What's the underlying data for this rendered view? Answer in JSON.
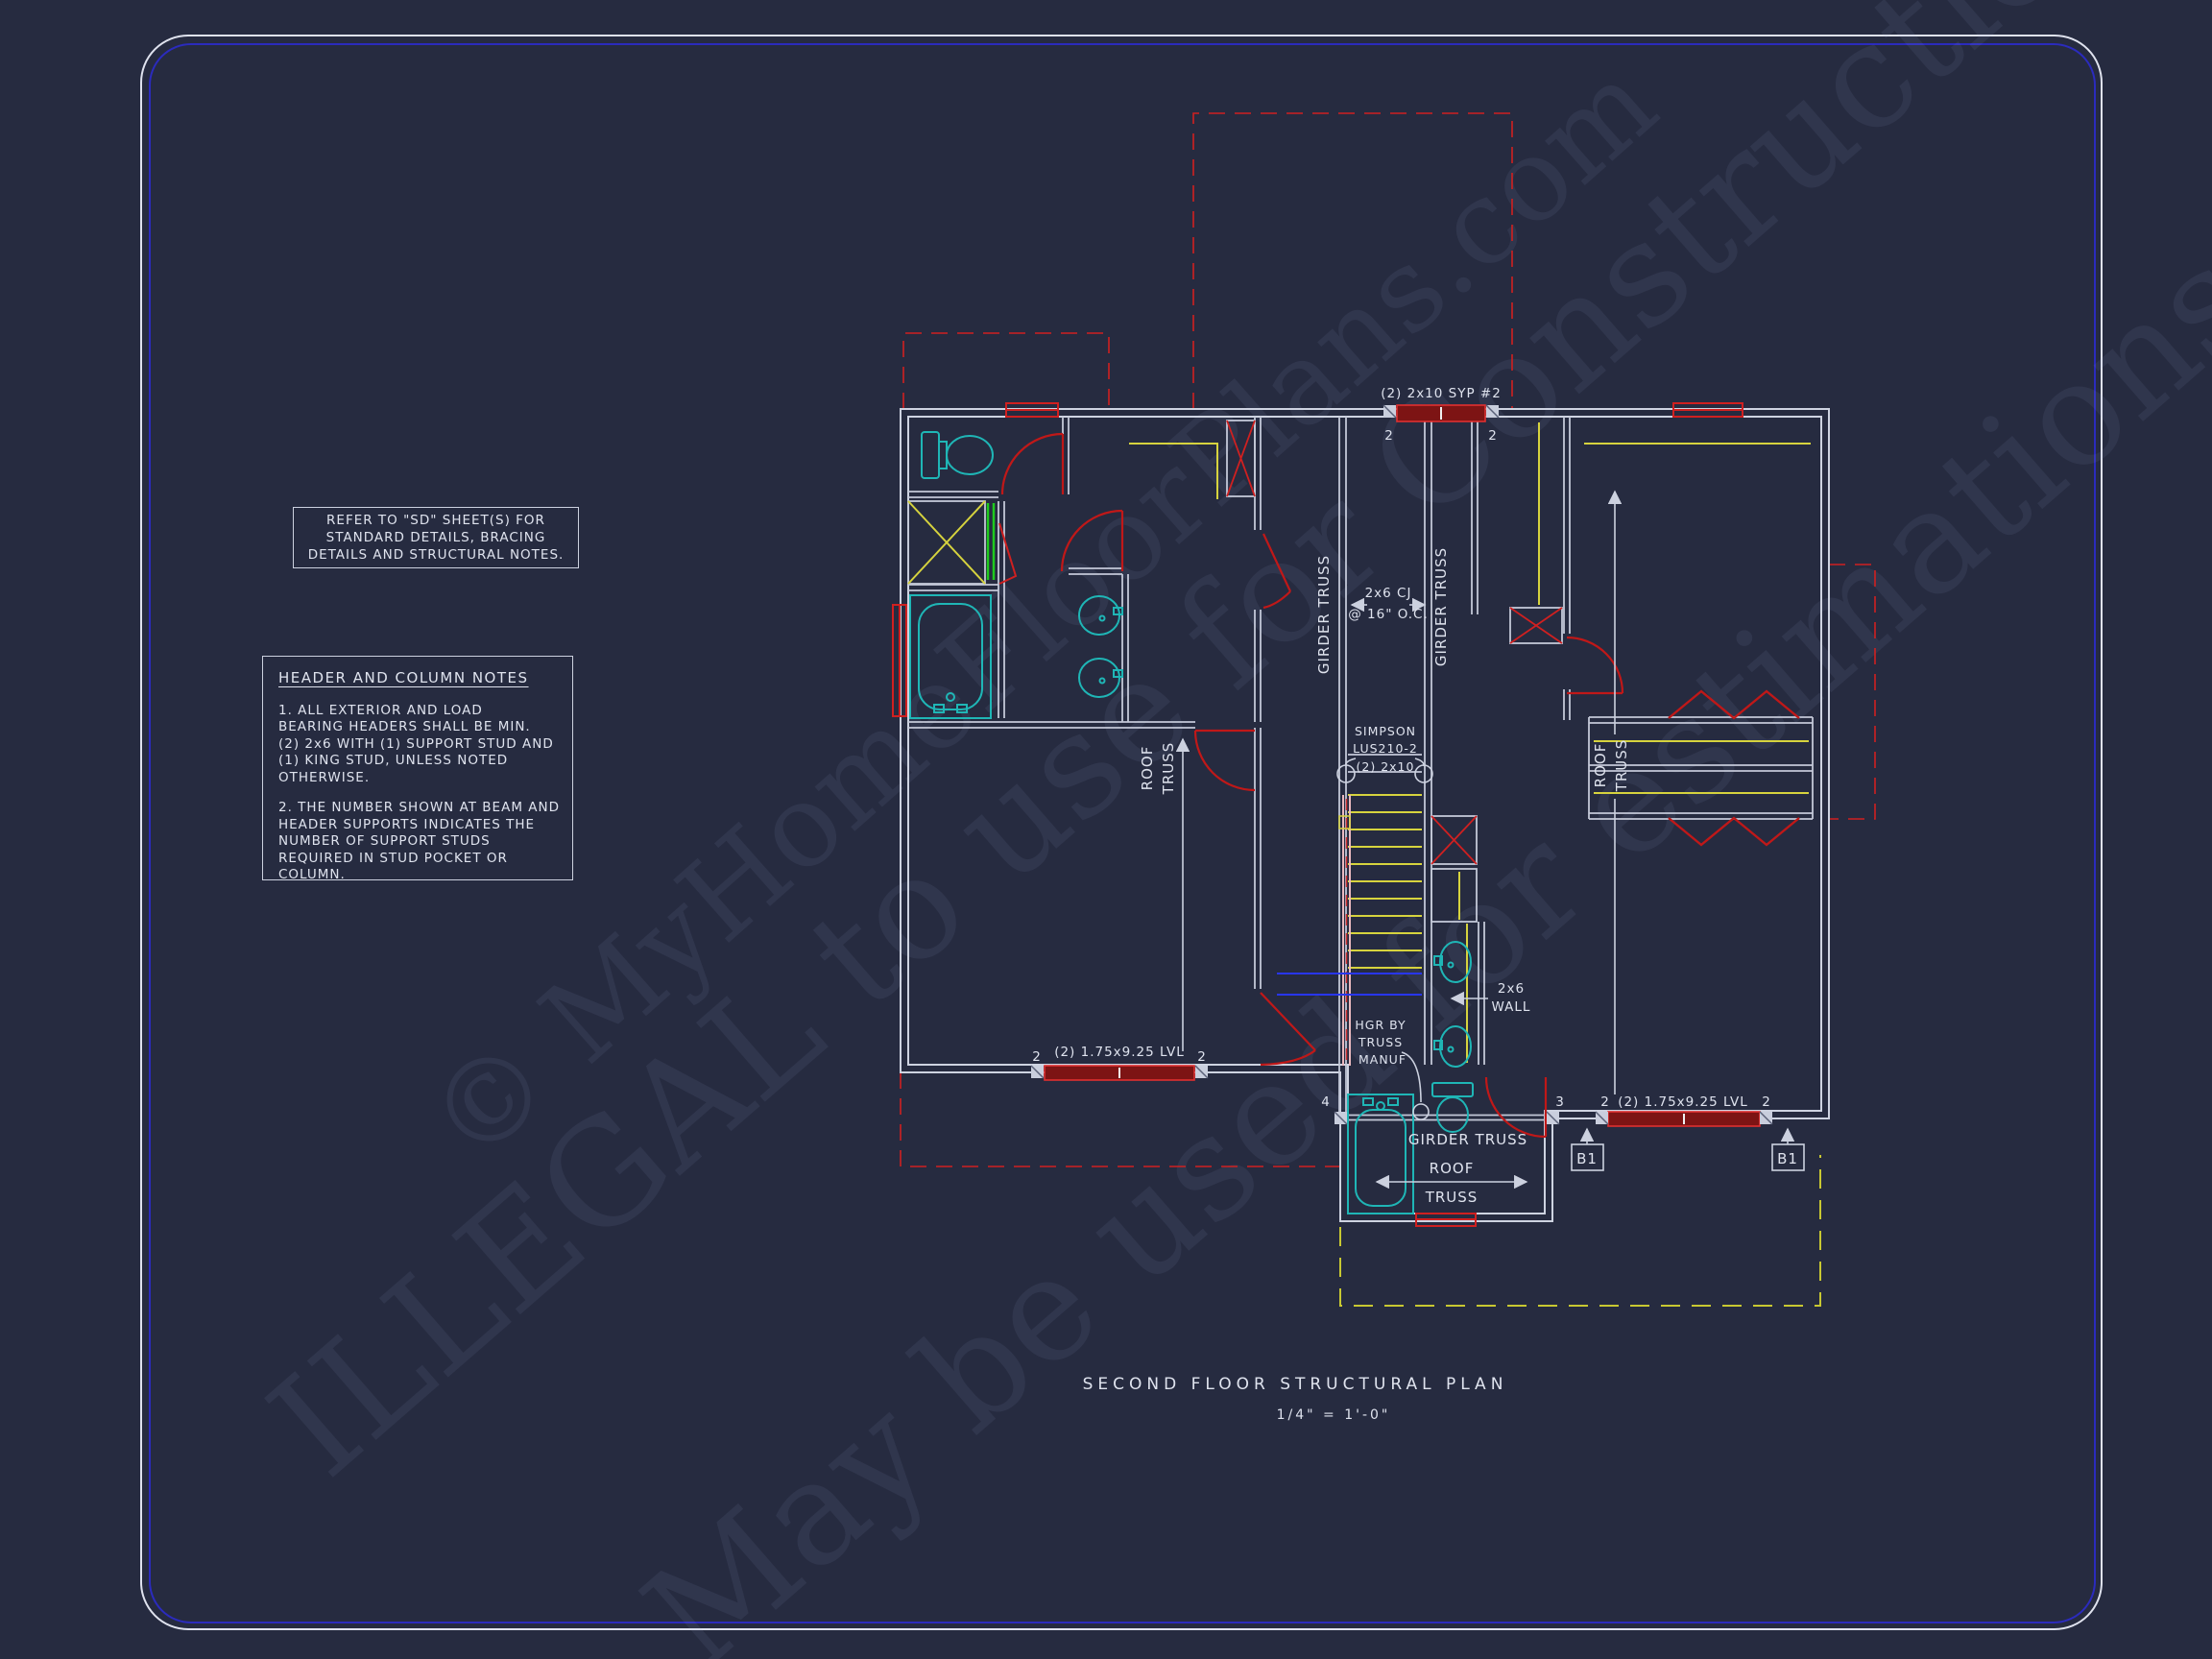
{
  "sheet": {
    "bg": "#262b40",
    "border_outer_color": "#dfe2ee",
    "border_inner_color": "#2b2bbd",
    "line_color": "#ccd1df",
    "accent_red": "#d02020",
    "fixture_cyan": "#1fb6b6",
    "detail_yellow": "#d6d33e",
    "detail_green": "#1ecb1e",
    "detail_blue": "#2836f2",
    "text_color": "#dfe3ee"
  },
  "watermarks": {
    "wm1": "© MyHomeFloorPlans.com",
    "wm2": "ILLEGAL to use for Construction",
    "wm3": "May be used for estimations"
  },
  "refer_note": {
    "line1": "REFER TO \"SD\"  SHEET(S) FOR",
    "line2": "STANDARD DETAILS, BRACING",
    "line3": "DETAILS AND STRUCTURAL NOTES."
  },
  "header_notes": {
    "title": "HEADER AND COLUMN NOTES",
    "n1l1": "1. ALL EXTERIOR AND LOAD",
    "n1l2": "BEARING HEADERS SHALL BE MIN.",
    "n1l3": "(2) 2x6 WITH (1) SUPPORT STUD AND",
    "n1l4": "(1) KING STUD, UNLESS NOTED",
    "n1l5": "OTHERWISE.",
    "n2l1": "2. THE NUMBER SHOWN AT BEAM AND",
    "n2l2": "HEADER SUPPORTS INDICATES THE",
    "n2l3": "NUMBER OF SUPPORT STUDS",
    "n2l4": "REQUIRED IN STUD POCKET OR",
    "n2l5": "COLUMN."
  },
  "title_block": {
    "title": "SECOND FLOOR STRUCTURAL PLAN",
    "scale": "1/4\" = 1'-0\""
  },
  "plan": {
    "labels": {
      "syp_header": "(2) 2x10 SYP #2",
      "lvl_beam": "(2) 1.75x9.25 LVL",
      "girder_truss": "GIRDER TRUSS",
      "roof_word": "ROOF",
      "truss_word": "TRUSS",
      "cj_line1": "2x6 CJ",
      "cj_line2": "@ 16\" O.C.",
      "simpson_line1": "SIMPSON",
      "simpson_line2": "LUS210-2",
      "simpson_line3": "(2) 2x10",
      "wall_line1": "2x6",
      "wall_line2": "WALL",
      "hgr_line1": "HGR BY",
      "hgr_line2": "TRUSS",
      "hgr_line3": "MANUF",
      "beam_mark": "B1",
      "support_2": "2",
      "support_3": "3",
      "support_4": "4"
    }
  }
}
